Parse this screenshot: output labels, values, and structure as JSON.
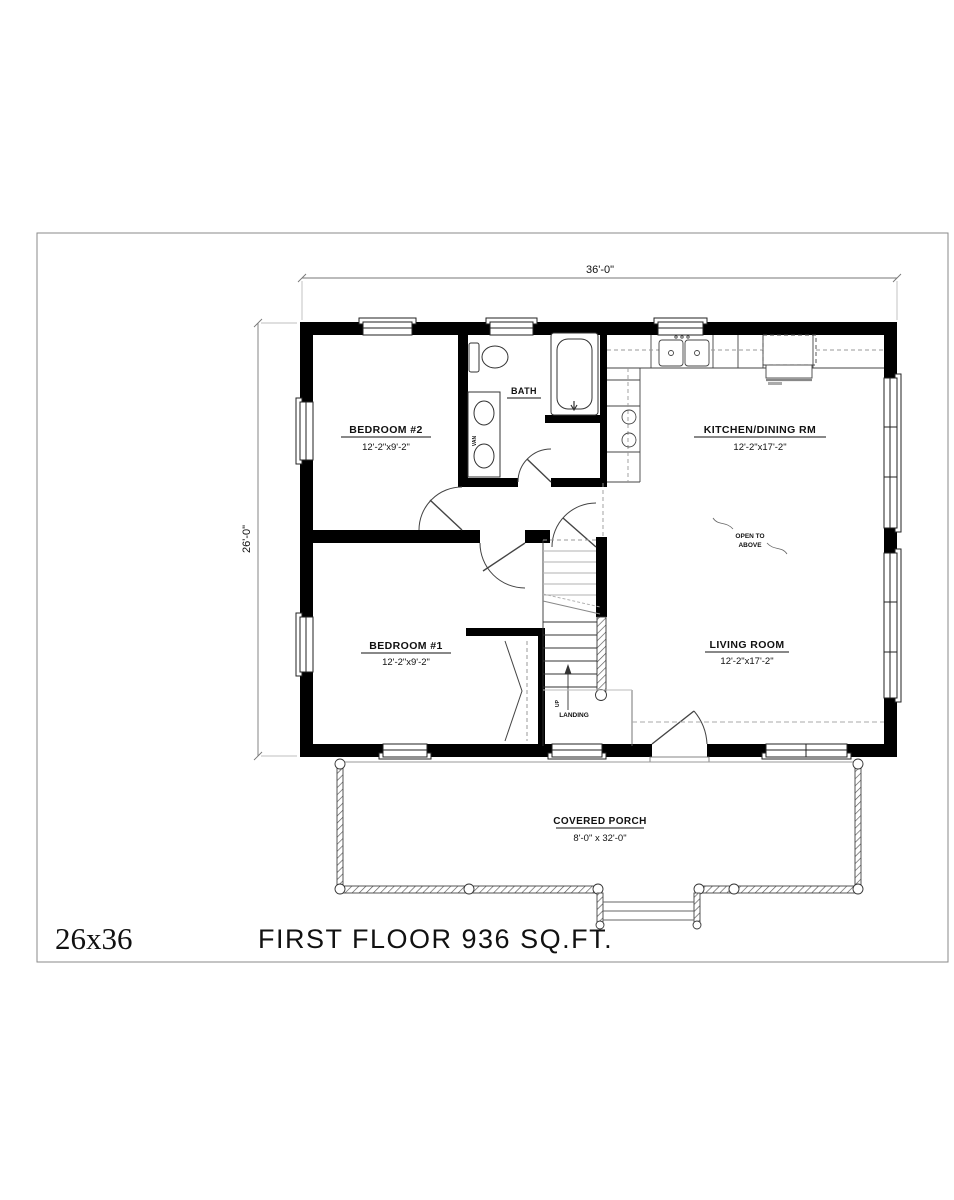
{
  "drawing": {
    "footer": {
      "model": "26x36",
      "title": "FIRST FLOOR 936 SQ.FT."
    },
    "dimensions": {
      "width": "36'-0\"",
      "depth": "26'-0\""
    },
    "rooms": {
      "bedroom2": {
        "label": "BEDROOM #2",
        "size": "12'-2\"x9'-2\""
      },
      "bath": {
        "label": "BATH"
      },
      "kitchen": {
        "label": "KITCHEN/DINING RM",
        "size": "12'-2\"x17'-2\""
      },
      "bedroom1": {
        "label": "BEDROOM #1",
        "size": "12'-2\"x9'-2\""
      },
      "living": {
        "label": "LIVING ROOM",
        "size": "12'-2\"x17'-2\""
      },
      "porch": {
        "label": "COVERED PORCH",
        "size": "8'-0\" x 32'-0\""
      }
    },
    "annotations": {
      "open_to_above_1": "OPEN TO",
      "open_to_above_2": "ABOVE",
      "landing": "LANDING",
      "up": "UP",
      "vanity": "VAN"
    },
    "colors": {
      "wall": "#000000",
      "line": "#444444",
      "dash": "#999999",
      "text": "#111111"
    }
  }
}
